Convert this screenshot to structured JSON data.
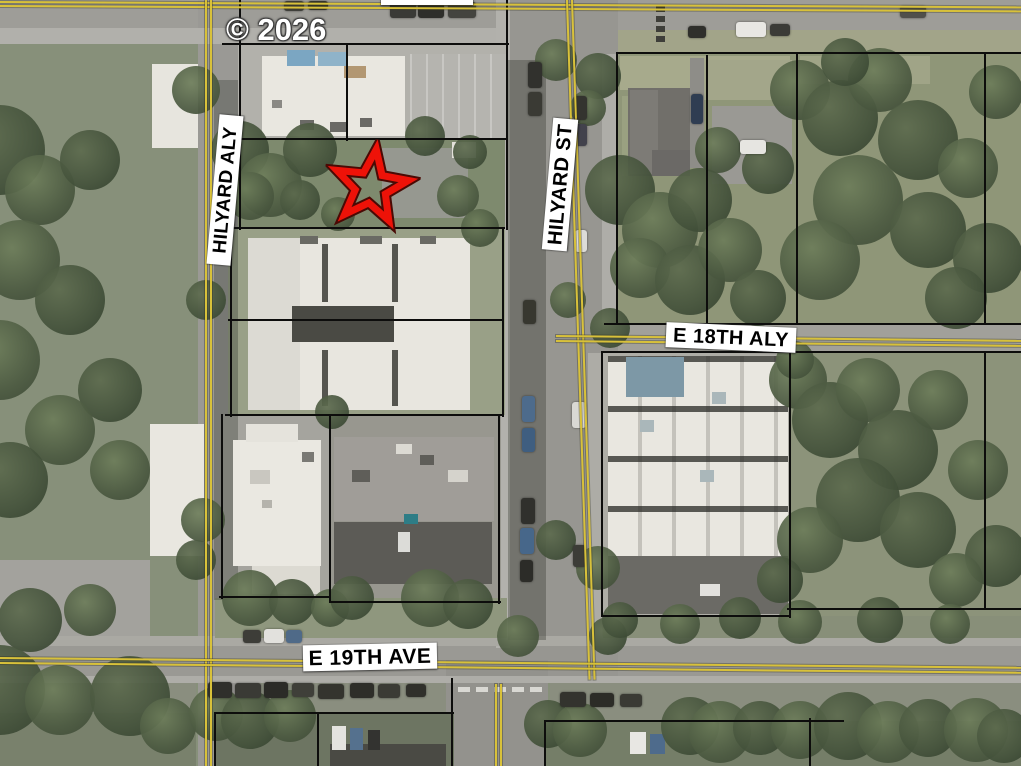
{
  "map": {
    "type": "aerial-parcel-map",
    "watermark": "© 2026",
    "street_labels": {
      "top_partial": "E 18TH AVE",
      "hilyard_aly": "HILYARD ALY",
      "hilyard_st": "HILYARD ST",
      "e_18th_aly": "E 18TH ALY",
      "e_19th_ave": "E 19TH AVE"
    },
    "marker": {
      "shape": "star",
      "color": "#ee1208",
      "outline_color": "#4a0a05"
    },
    "colors": {
      "parcel_line": "#0d0d0c",
      "road_centerline_yellow": "#d8c13a",
      "label_background": "#ffffff",
      "label_text": "#000000",
      "watermark_text": "#ffffff"
    }
  }
}
